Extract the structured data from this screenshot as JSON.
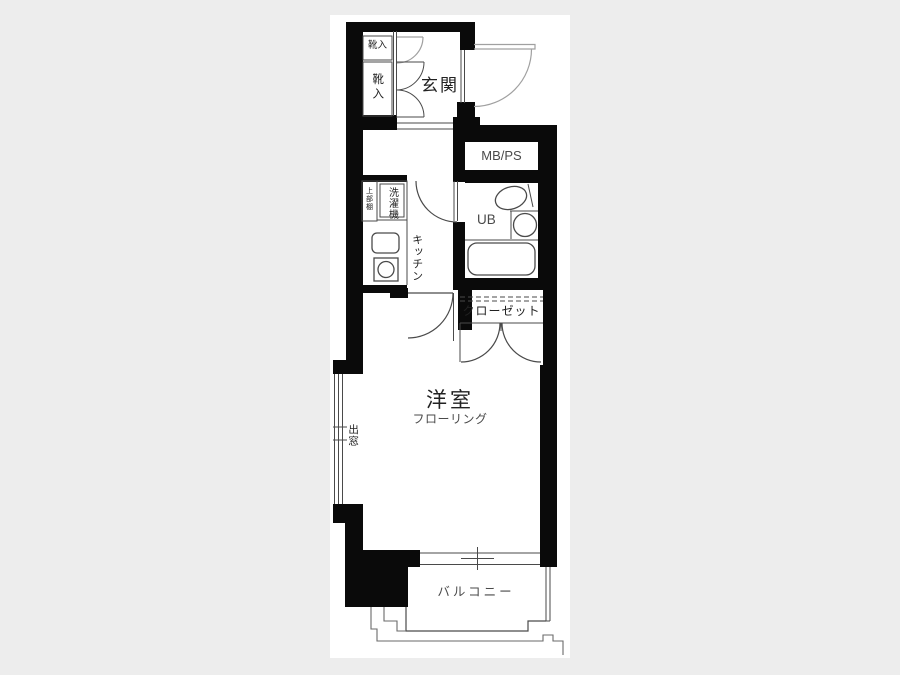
{
  "floor_plan": {
    "labels": {
      "entrance": "玄関",
      "shoe_cabinet_upper": "靴入",
      "shoe_cabinet_lower": "靴入",
      "meter_box": "MB/PS",
      "unit_bath": "UB",
      "washing_machine": "洗濯機",
      "upper_shelf": "上部棚",
      "kitchen": "キッチン",
      "closet": "クローゼット",
      "western_room": "洋室",
      "western_room_sub": "フローリング",
      "bay_window": "出窓",
      "balcony": "バルコニー"
    },
    "colors": {
      "background": "#ededed",
      "floor": "#ffffff",
      "wall": "#0a0a0a",
      "line": "#4a4a4a",
      "door_swing": "#a0a0a0"
    }
  }
}
